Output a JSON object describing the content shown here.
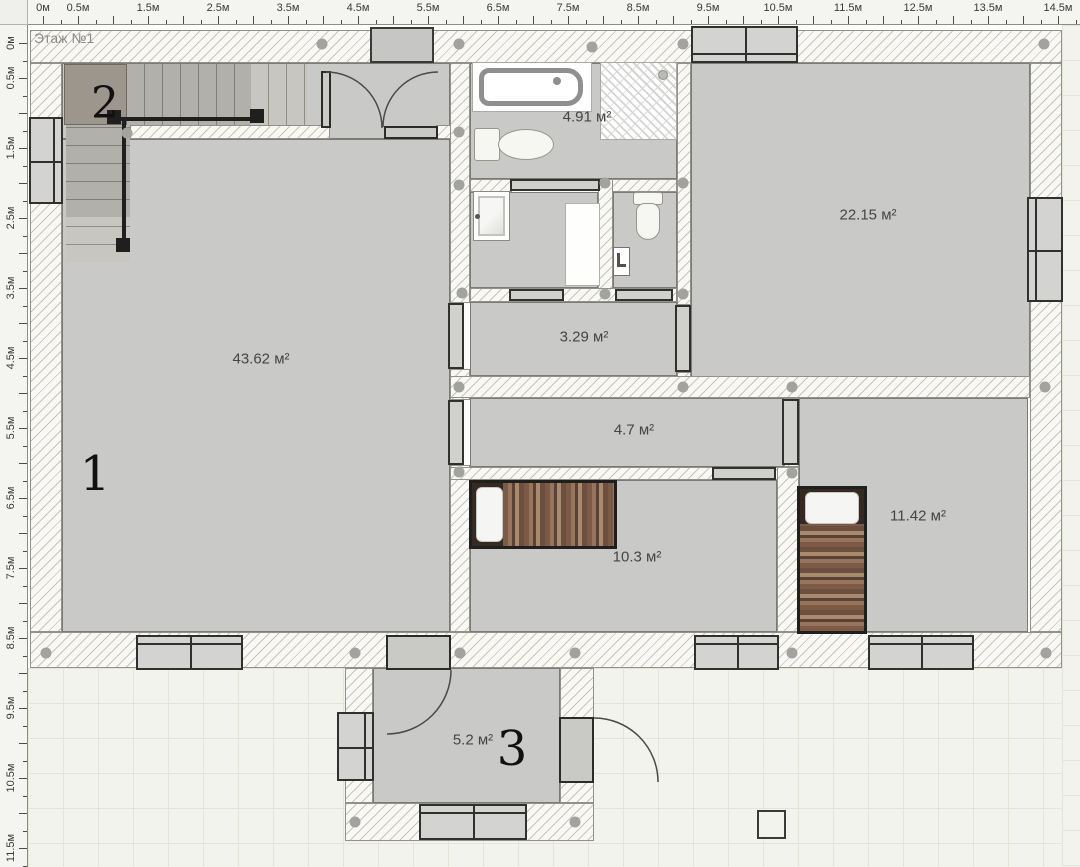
{
  "floor": {
    "label": "Этаж №1"
  },
  "rulers": {
    "unit": "м",
    "top_labels": [
      {
        "m": 0,
        "t": "0м"
      },
      {
        "m": 0.5,
        "t": "0.5м"
      },
      {
        "m": 1.5,
        "t": "1.5м"
      },
      {
        "m": 2.5,
        "t": "2.5м"
      },
      {
        "m": 3.5,
        "t": "3.5м"
      },
      {
        "m": 4.5,
        "t": "4.5м"
      },
      {
        "m": 5.5,
        "t": "5.5м"
      },
      {
        "m": 6.5,
        "t": "6.5м"
      },
      {
        "m": 7.5,
        "t": "7.5м"
      },
      {
        "m": 8.5,
        "t": "8.5м"
      },
      {
        "m": 9.5,
        "t": "9.5м"
      },
      {
        "m": 10.5,
        "t": "10.5м"
      },
      {
        "m": 11.5,
        "t": "11.5м"
      },
      {
        "m": 12.5,
        "t": "12.5м"
      },
      {
        "m": 13.5,
        "t": "13.5м"
      },
      {
        "m": 14.5,
        "t": "14.5м"
      }
    ],
    "left_labels": [
      {
        "m": 0,
        "t": "0м"
      },
      {
        "m": 0.5,
        "t": "0.5м"
      },
      {
        "m": 1.5,
        "t": "1.5м"
      },
      {
        "m": 2.5,
        "t": "2.5м"
      },
      {
        "m": 3.5,
        "t": "3.5м"
      },
      {
        "m": 4.5,
        "t": "4.5м"
      },
      {
        "m": 5.5,
        "t": "5.5м"
      },
      {
        "m": 6.5,
        "t": "6.5м"
      },
      {
        "m": 7.5,
        "t": "7.5м"
      },
      {
        "m": 8.5,
        "t": "8.5м"
      },
      {
        "m": 9.5,
        "t": "9.5м"
      },
      {
        "m": 10.5,
        "t": "10.5м"
      },
      {
        "m": 11.5,
        "t": "11.5м"
      }
    ]
  },
  "rooms": [
    {
      "id": "living-room",
      "number": "1",
      "area": "43.62 м²"
    },
    {
      "id": "stair-hall",
      "number": "2",
      "area": ""
    },
    {
      "id": "bathroom",
      "number": "",
      "area": "4.91 м²"
    },
    {
      "id": "bedroom-large",
      "number": "",
      "area": "22.15 м²"
    },
    {
      "id": "corridor-upper",
      "number": "",
      "area": "3.29 м²"
    },
    {
      "id": "corridor-lower",
      "number": "",
      "area": "4.7 м²"
    },
    {
      "id": "bedroom-left",
      "number": "",
      "area": "10.3 м²"
    },
    {
      "id": "bedroom-right",
      "number": "",
      "area": "11.42 м²"
    },
    {
      "id": "vestibule",
      "number": "3",
      "area": "5.2 м²"
    }
  ],
  "colors": {
    "room_fill": "#c9c9c7",
    "wall_edge": "#92928c",
    "tile_bg": "#f3f3ee",
    "window_frame": "#30302e",
    "blanket_brown": "#7c5a46",
    "anchor_dot": "#a2a29e"
  }
}
